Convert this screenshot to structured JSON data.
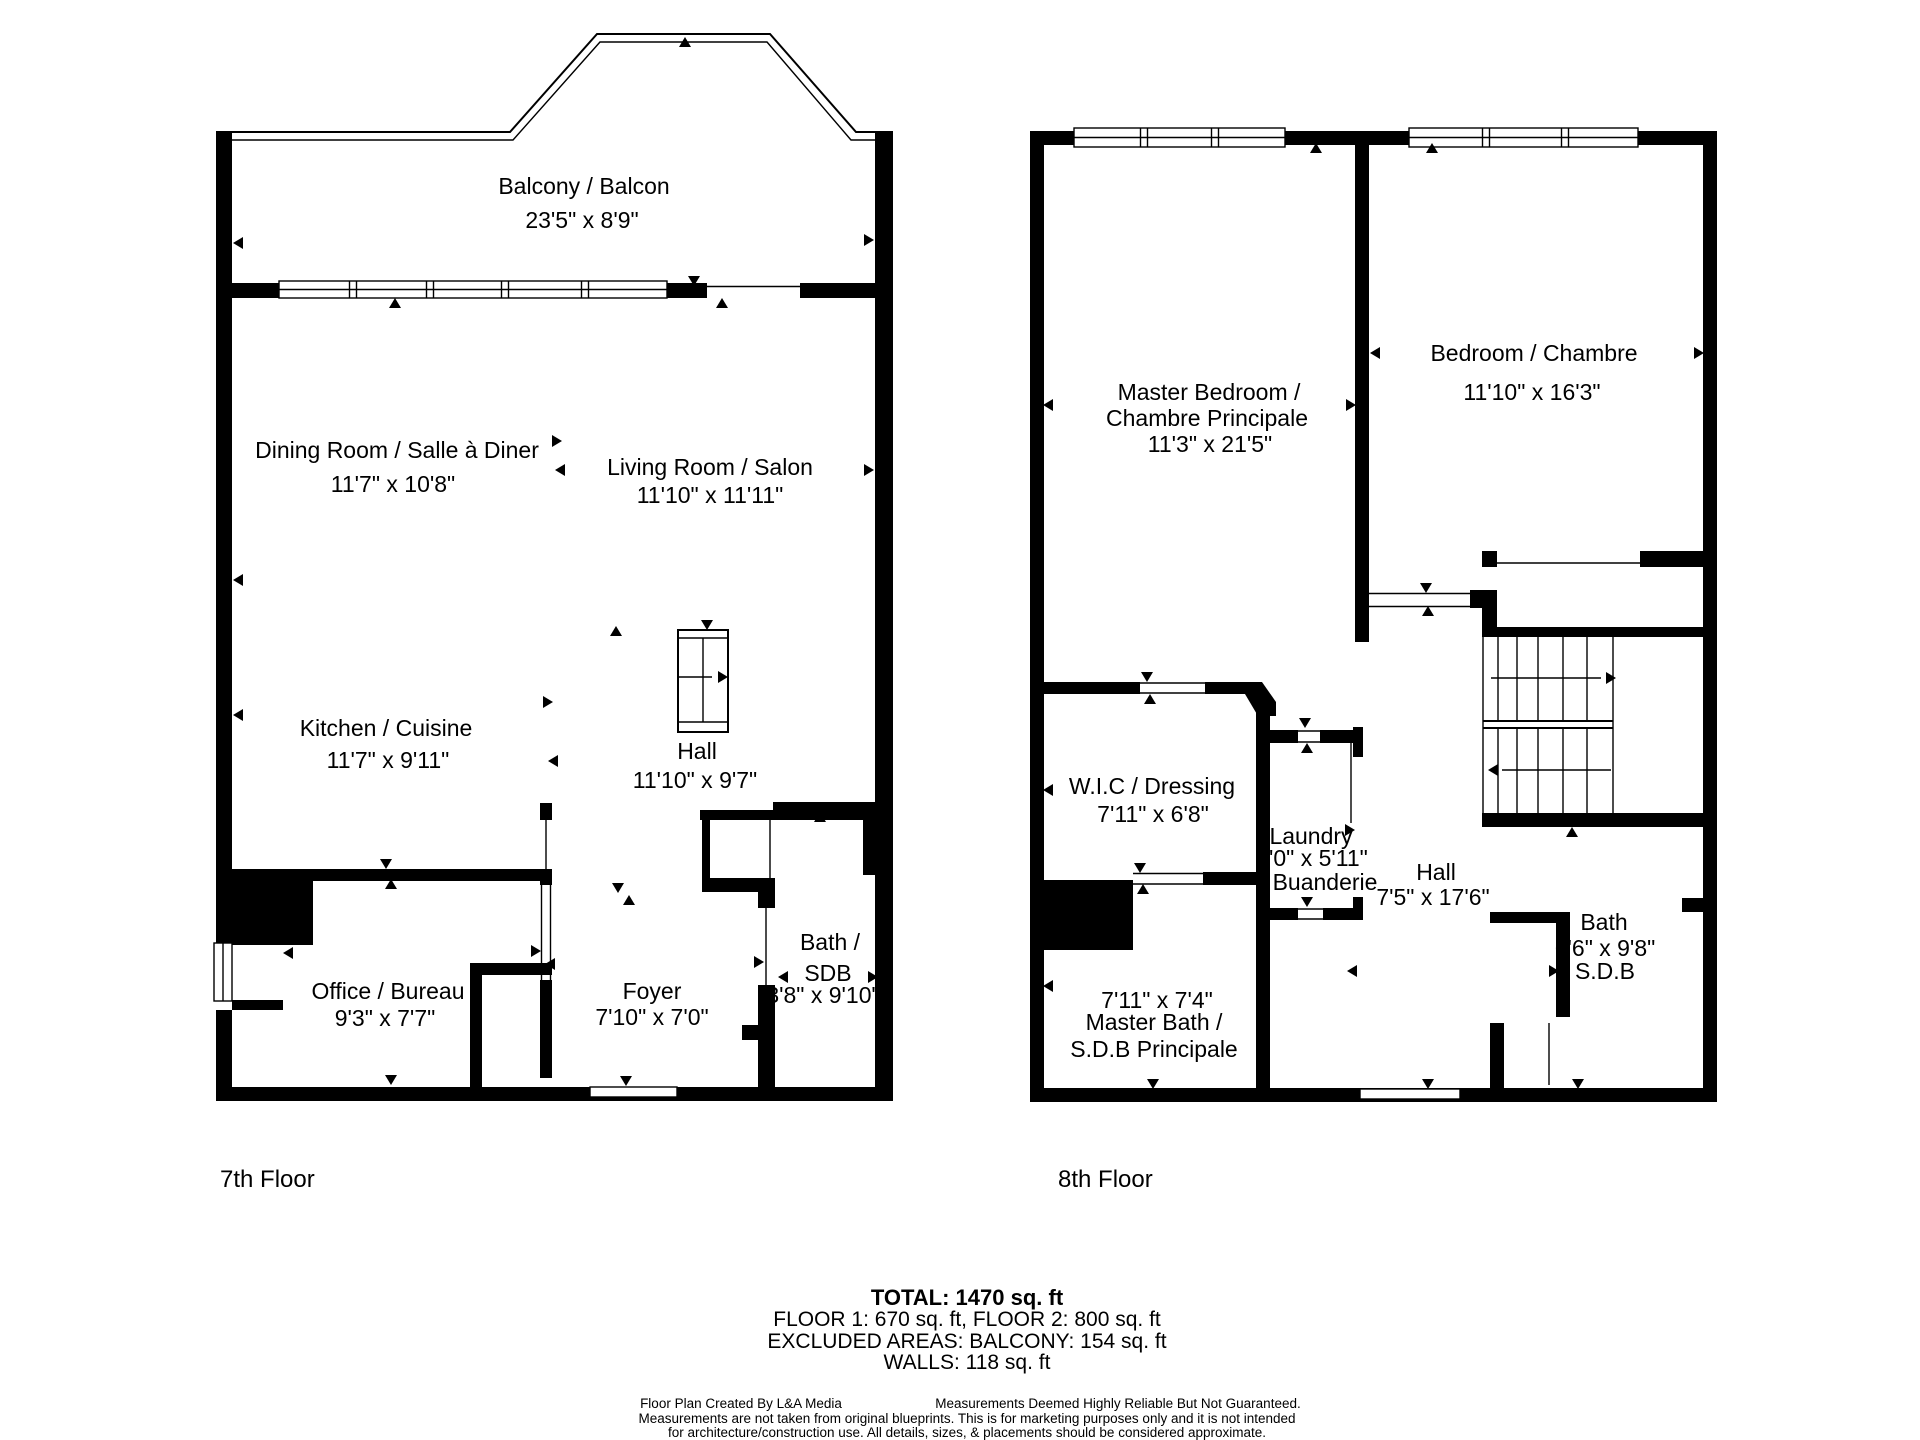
{
  "floor7": {
    "label": "7th Floor",
    "rooms": {
      "balcony": {
        "name": "Balcony / Balcon",
        "dims": "23'5\" x 8'9\""
      },
      "dining": {
        "name": "Dining Room / Salle à Diner",
        "dims": "11'7\" x 10'8\""
      },
      "living": {
        "name": "Living Room / Salon",
        "dims": "11'10\" x 11'11\""
      },
      "kitchen": {
        "name": "Kitchen / Cuisine",
        "dims": "11'7\" x 9'11\""
      },
      "hall": {
        "name": "Hall",
        "dims": "11'10\" x 9'7\""
      },
      "office": {
        "name": "Office / Bureau",
        "dims": "9'3\" x 7'7\""
      },
      "foyer": {
        "name": "Foyer",
        "dims": "7'10\" x 7'0\""
      },
      "bath": {
        "name_line1": "Bath /",
        "name_line2": "SDB",
        "dims": "3'8\" x 9'10\""
      }
    }
  },
  "floor8": {
    "label": "8th Floor",
    "rooms": {
      "master_bedroom": {
        "name_line1": "Master Bedroom /",
        "name_line2": "Chambre Principale",
        "dims": "11'3\" x 21'5\""
      },
      "bedroom": {
        "name": "Bedroom / Chambre",
        "dims": "11'10\" x 16'3\""
      },
      "wic": {
        "name": "W.I.C / Dressing",
        "dims": "7'11\" x 6'8\""
      },
      "laundry": {
        "name_en": "Laundry",
        "dims": "3'0\" x 5'11\"",
        "name_fr": "Buanderie"
      },
      "hall": {
        "name": "Hall",
        "dims": "7'5\" x 17'6\""
      },
      "bath": {
        "name_en": "Bath",
        "dims": "6'6\" x 9'8\"",
        "name_fr": "S.D.B"
      },
      "master_bath": {
        "dims": "7'11\" x 7'4\"",
        "name_line1": "Master Bath /",
        "name_line2": "S.D.B Principale"
      }
    }
  },
  "summary": {
    "total": "TOTAL: 1470 sq. ft",
    "floors": "FLOOR 1: 670 sq. ft, FLOOR 2: 800 sq. ft",
    "excluded": "EXCLUDED AREAS: BALCONY: 154 sq. ft",
    "walls": "WALLS: 118 sq. ft"
  },
  "disclaimer": {
    "credit": "Floor Plan Created By  L&A Media",
    "line1": "Measurements Deemed Highly Reliable But Not Guaranteed.",
    "line2": "Measurements are not taken from original blueprints. This is for marketing purposes only and it is not intended",
    "line3": "for architecture/construction use. All details, sizes, & placements should be considered approximate."
  },
  "colors": {
    "wall": "#000000",
    "background": "#ffffff",
    "text": "#000000"
  }
}
